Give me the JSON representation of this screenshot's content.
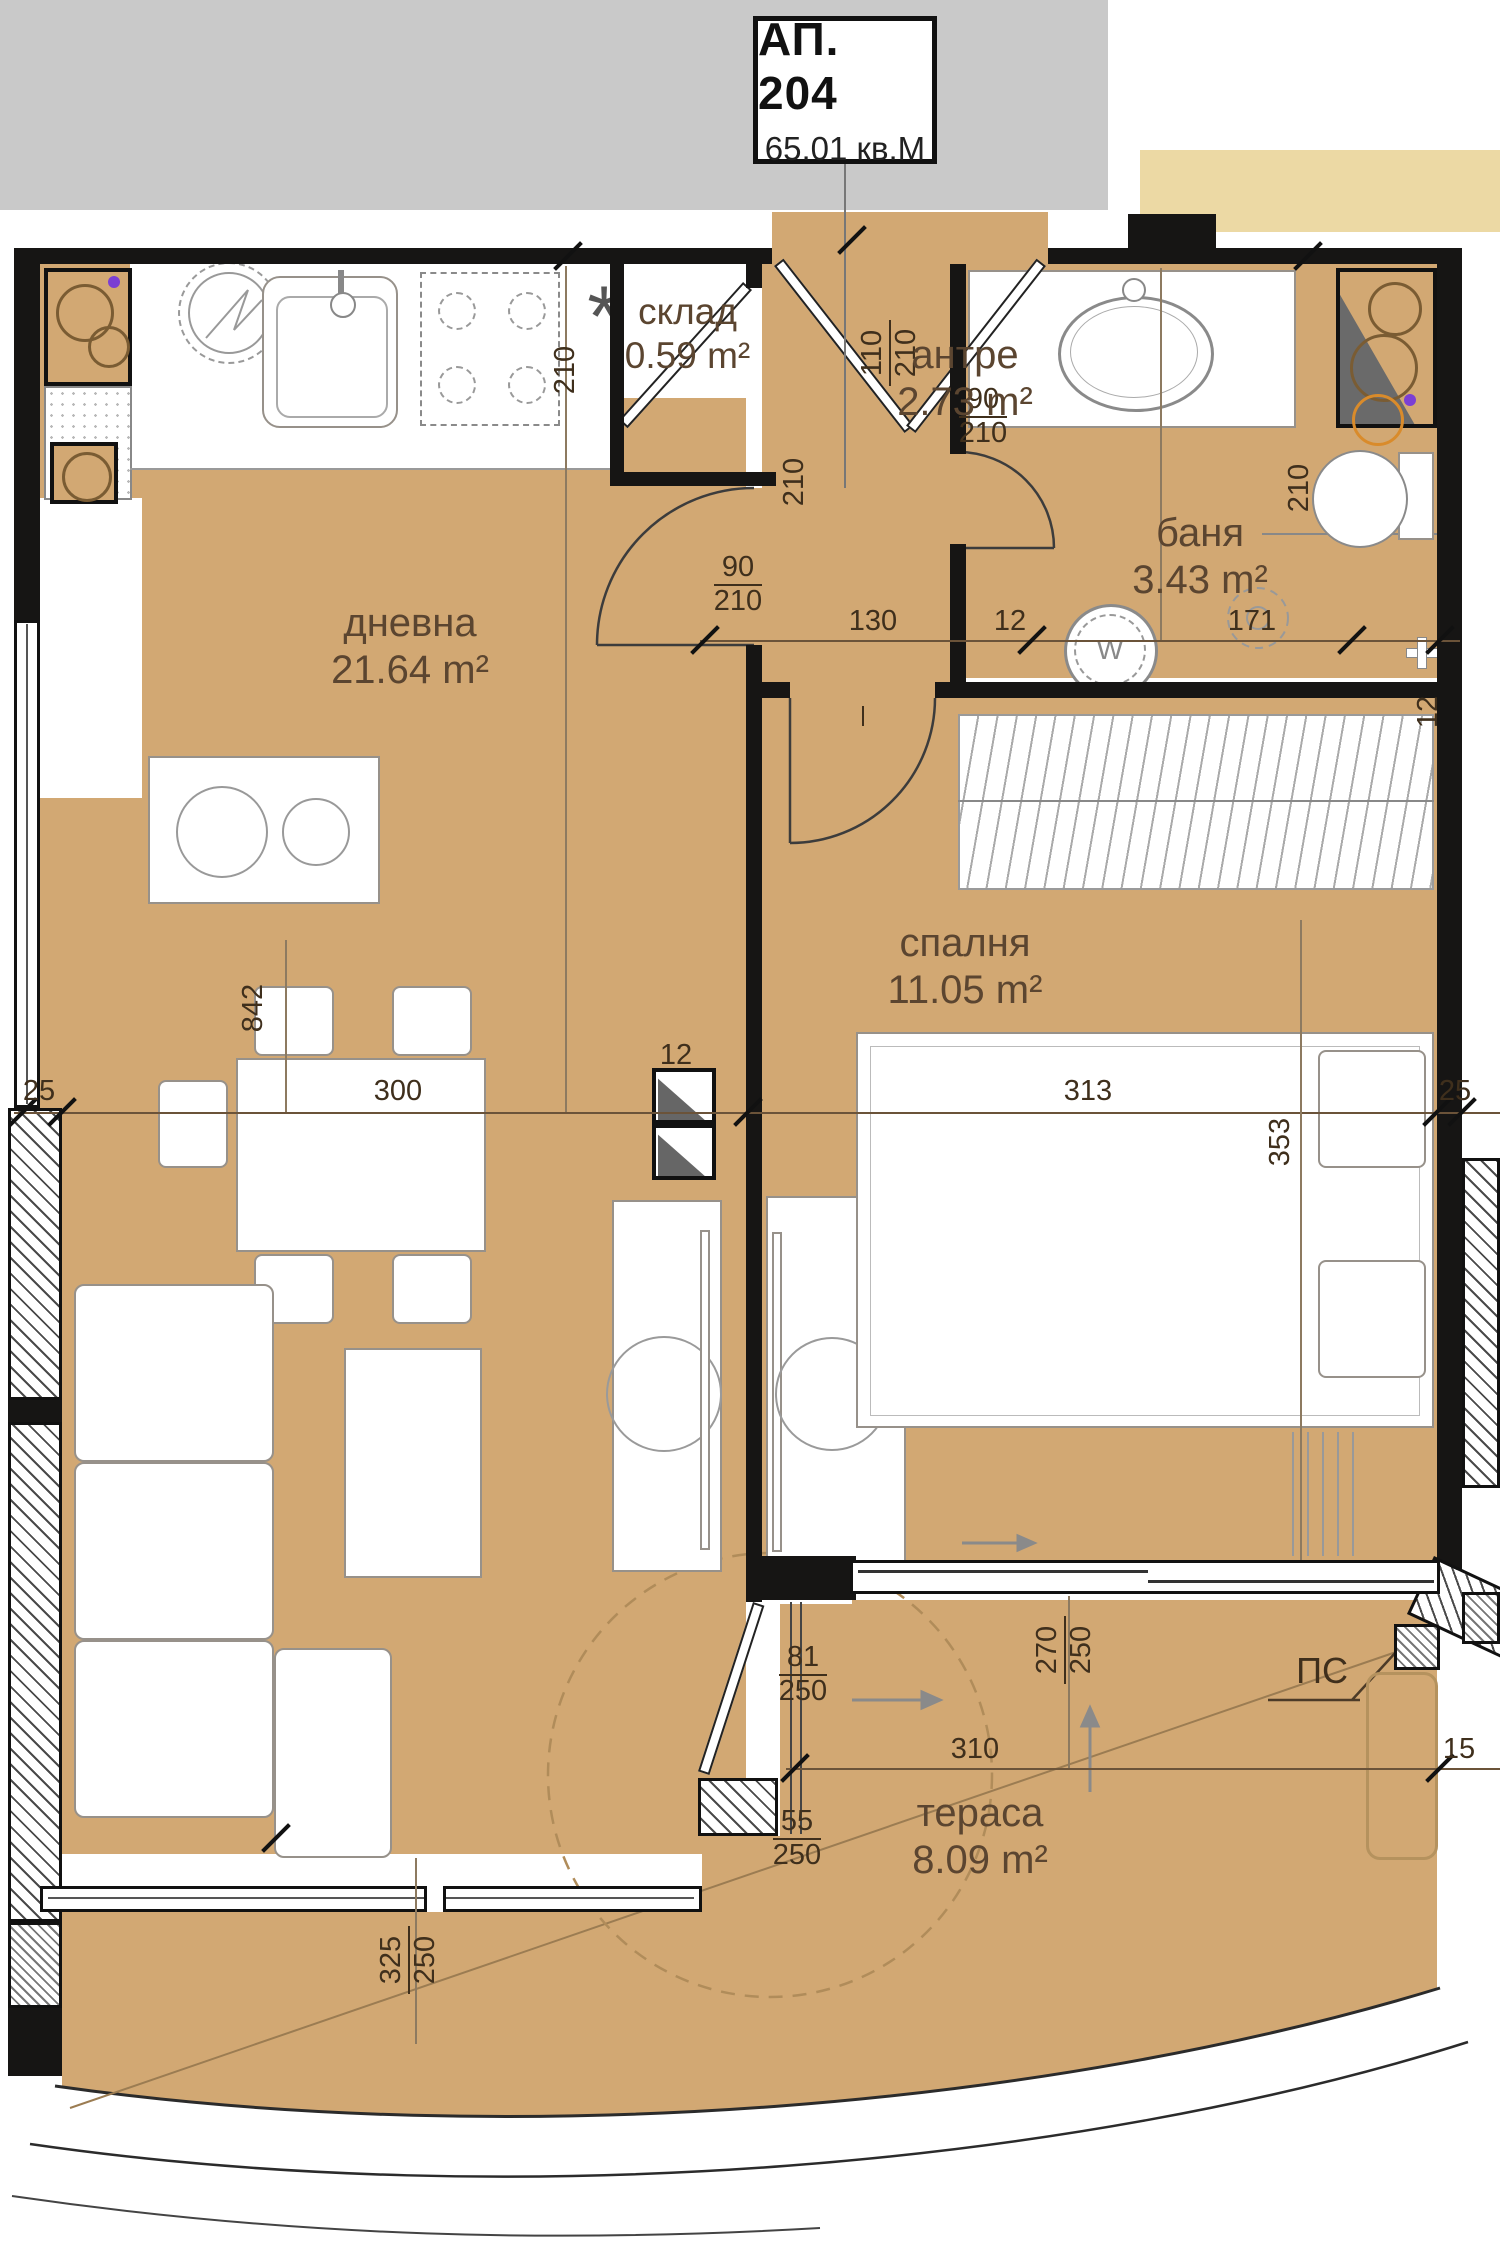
{
  "title_block": {
    "apartment_no": "АП. 204",
    "total_area": "65.01 кв.М"
  },
  "rooms": {
    "living": {
      "name": "дневна",
      "area": "21.64 m²"
    },
    "storage": {
      "name": "склад",
      "area": "0.59 m²"
    },
    "entry": {
      "name": "антре",
      "area": "2.73 m²"
    },
    "bathroom": {
      "name": "баня",
      "area": "3.43 m²"
    },
    "bedroom": {
      "name": "спалня",
      "area": "11.05 m²"
    },
    "terrace": {
      "name": "тераса",
      "area": "8.09 m²"
    }
  },
  "dimensions": {
    "entrance_door": {
      "w": "110",
      "h": "210"
    },
    "kitchen_height": "210",
    "hall_height": "210",
    "living_door": {
      "w": "90",
      "h": "210"
    },
    "hall_length": "130",
    "wall_thickness": "12",
    "bath_door": {
      "w": "90",
      "h": "210"
    },
    "bath_width": "171",
    "bath_height": "210",
    "bedroom_wall": "12",
    "left_wall": "25",
    "living_width": "300",
    "partition": "12",
    "bedroom_width": "313",
    "right_wall": "25",
    "living_length": "842",
    "bedroom_length": "353",
    "terrace_door": {
      "w": "270",
      "h": "250"
    },
    "terrace_window": {
      "w": "81",
      "h": "250"
    },
    "terrace_window2": {
      "w": "55",
      "h": "250"
    },
    "terrace_width": "310",
    "terrace_right": "15",
    "terrace_side": {
      "w": "325",
      "h": "250"
    }
  },
  "symbols": {
    "drain_label": "ПС",
    "kitchen_note": "*",
    "washer_mark": "W"
  },
  "colors": {
    "floor": "#d2a873",
    "wall": "#161514",
    "corridor_strip": "#c9c9c9",
    "neighbor_strip": "#ecd9a4",
    "dim_text": "#3f2f1c",
    "room_text": "#5b4530"
  }
}
